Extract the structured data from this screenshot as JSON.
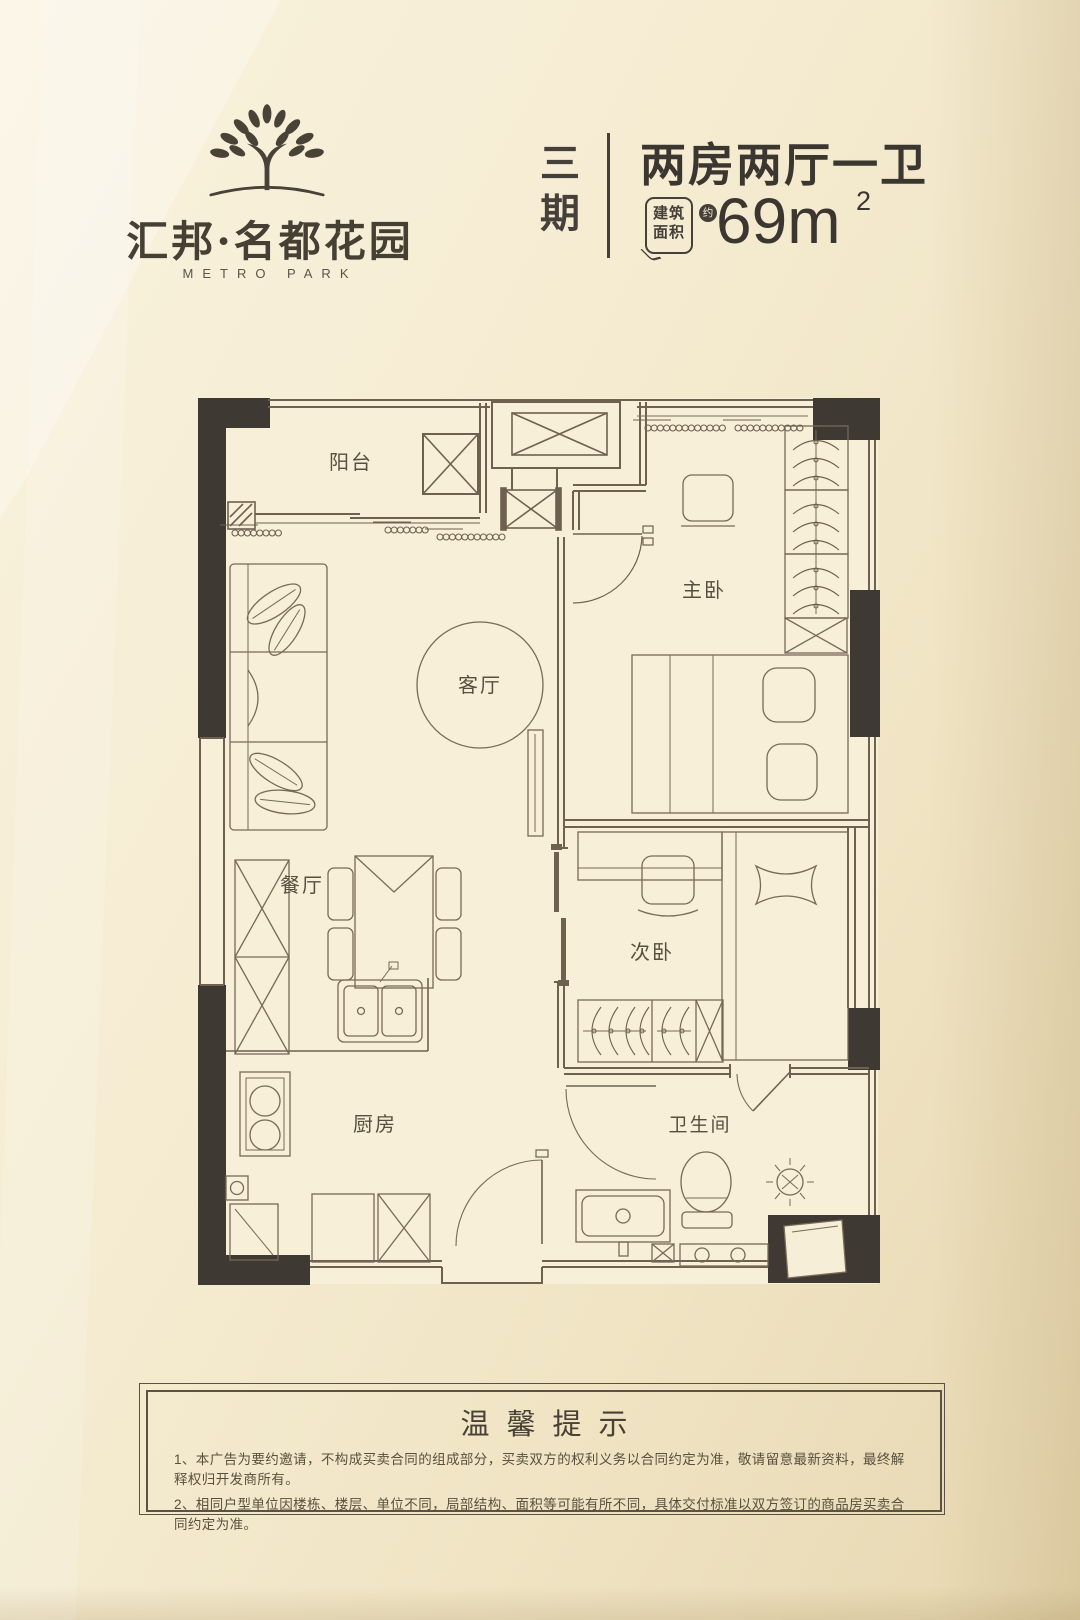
{
  "brand": {
    "cn_name": "汇邦·名都花园",
    "en_name": "METRO PARK"
  },
  "header": {
    "phase": "三期",
    "unit_title": "两房两厅一卫",
    "area_label": "建筑面积",
    "area_approx": "约",
    "area_value": "69m",
    "area_sup": "2"
  },
  "floorplan": {
    "rooms": {
      "balcony": "阳台",
      "living": "客厅",
      "dining": "餐厅",
      "kitchen": "厨房",
      "master": "主卧",
      "second": "次卧",
      "bath": "卫生间"
    }
  },
  "notice": {
    "title": "温馨提示",
    "lines": [
      "1、本广告为要约邀请，不构成买卖合同的组成部分，买卖双方的权利义务以合同约定为准，敬请留意最新资料，最终解释权归开发商所有。",
      "2、相同户型单位因楼栋、楼层、单位不同，局部结构、面积等可能有所不同，具体交付标准以双方签订的商品房买卖合同约定为准。"
    ]
  },
  "colors": {
    "background": "#f3ead0",
    "line": "#6e6150",
    "wall_dark": "#3e3a33",
    "text_dark": "#45403a"
  }
}
